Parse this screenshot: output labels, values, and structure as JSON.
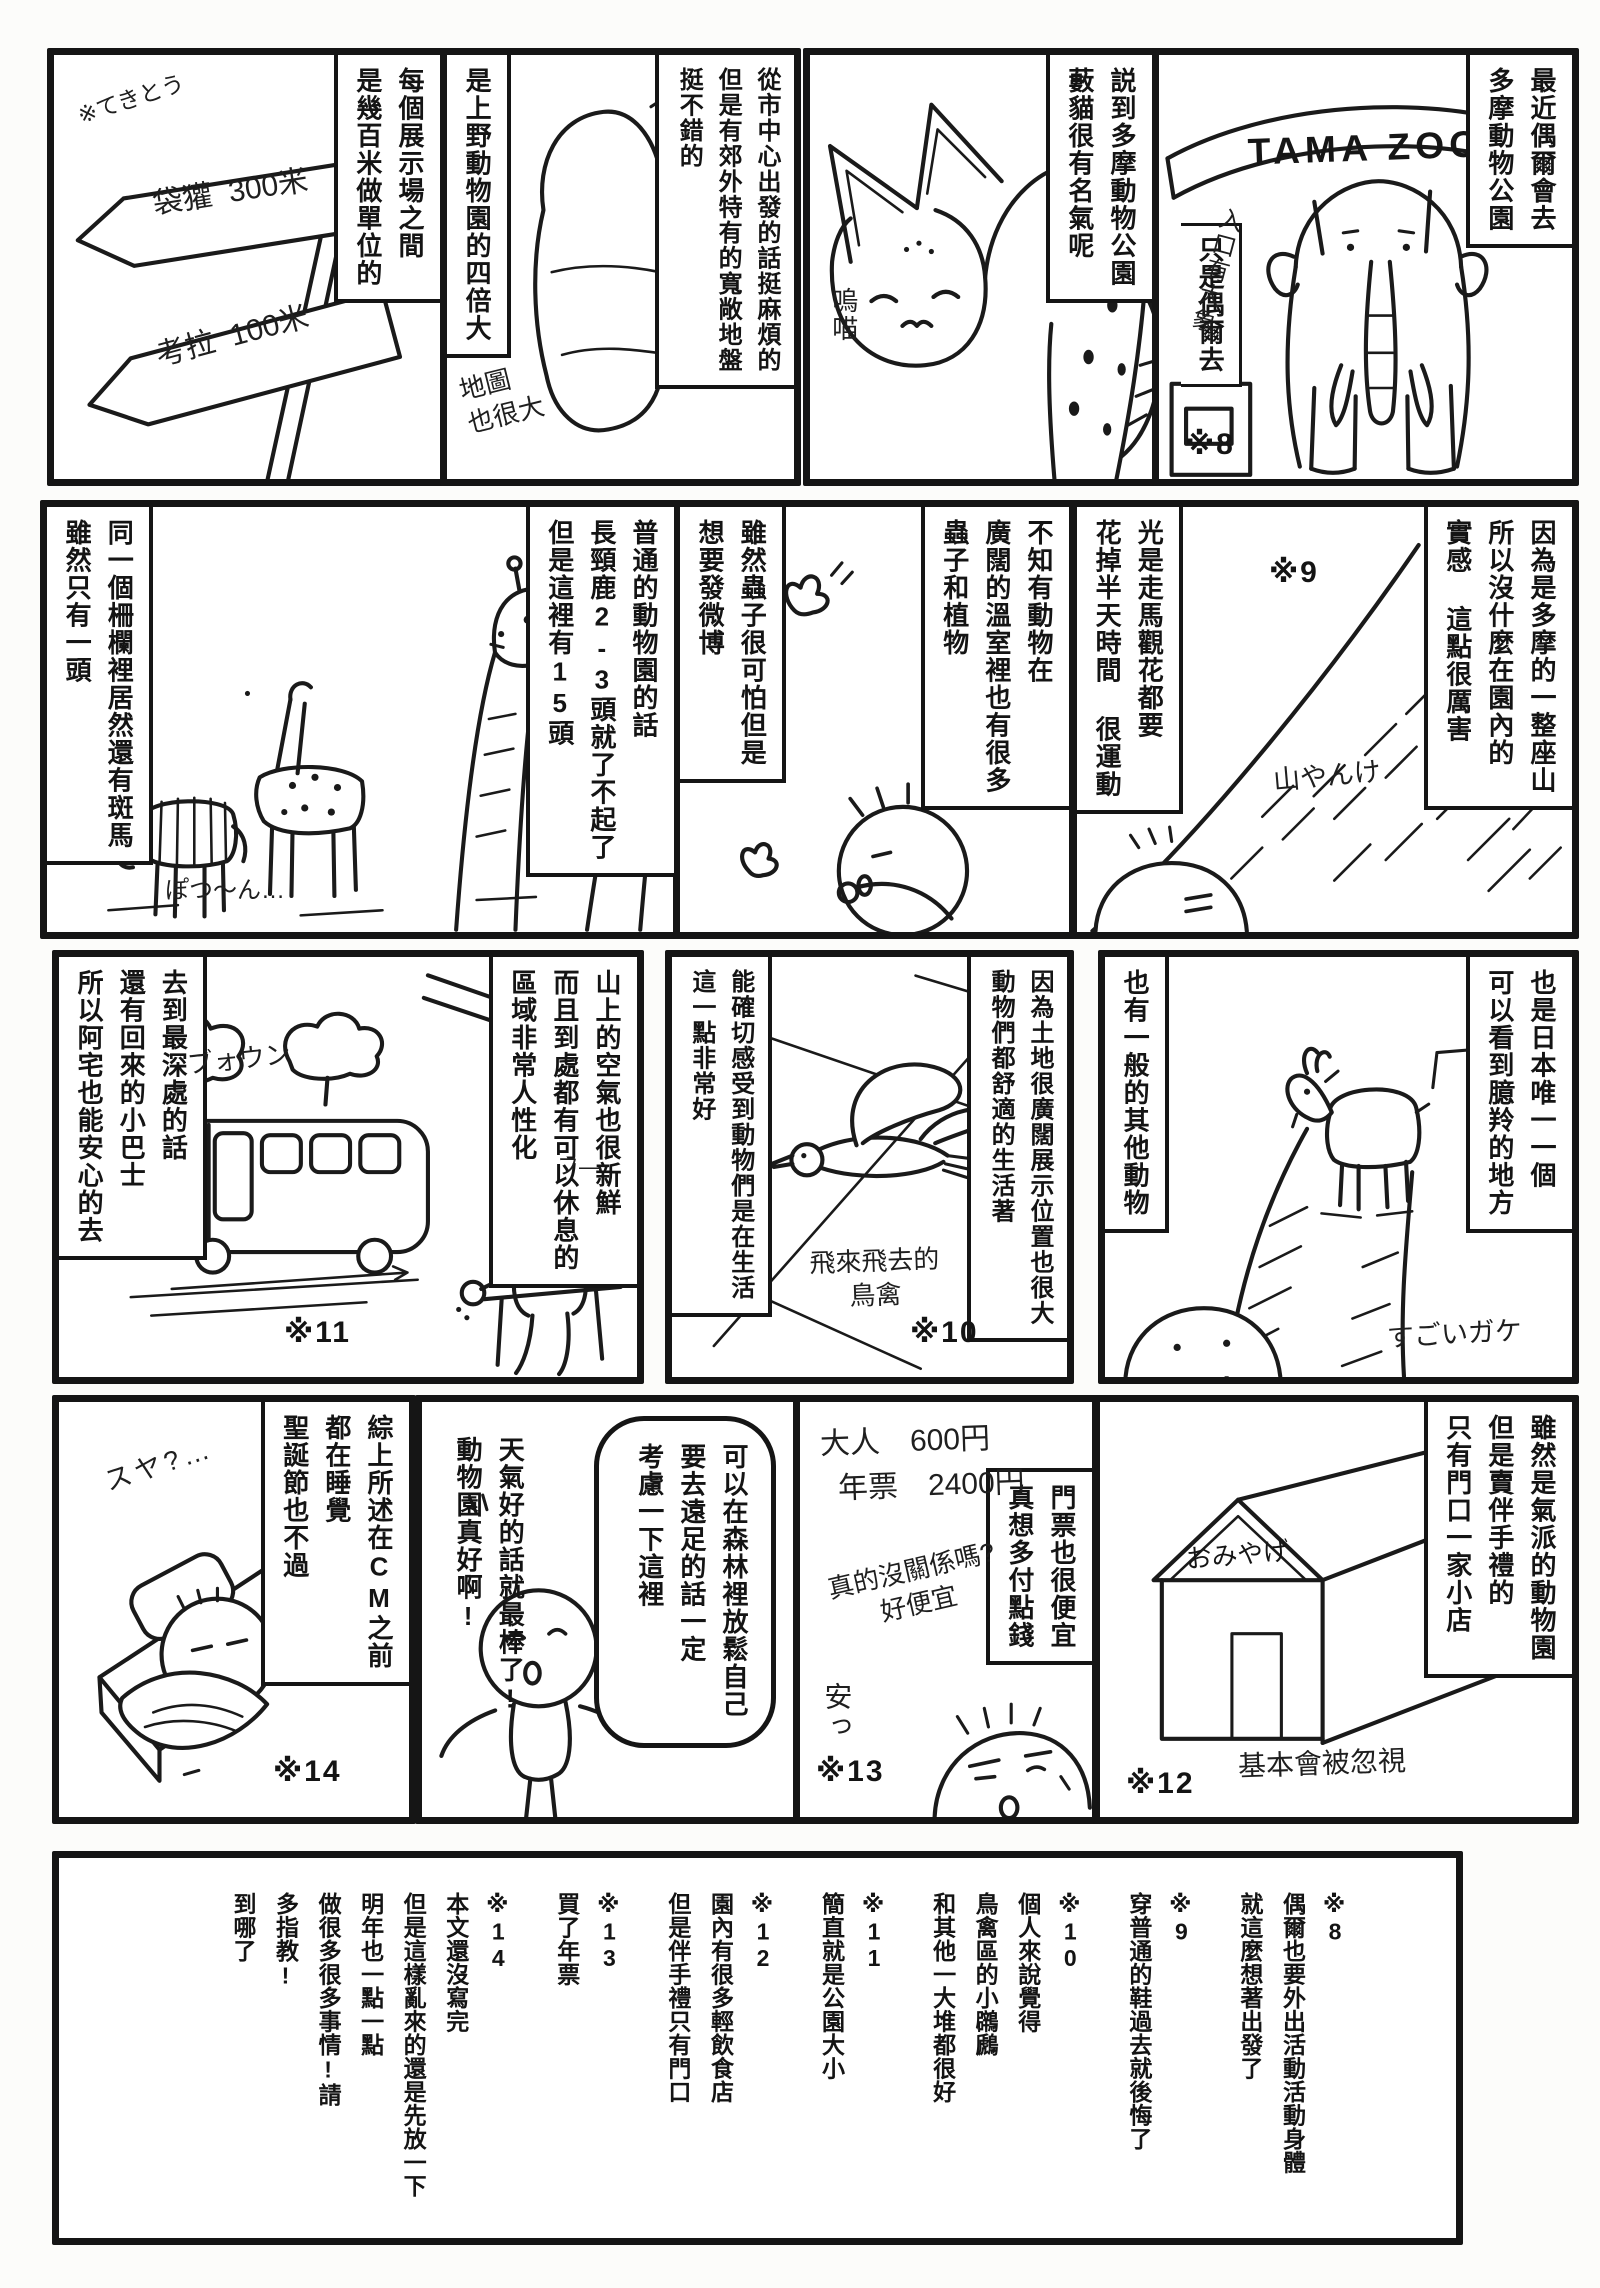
{
  "panels": {
    "signs": {
      "caption": "每個展示場之間\n是幾百米做單位的",
      "hand_note": "※てきとう",
      "sign_top": "袋獾  300米",
      "sign_bottom": "考拉  100米"
    },
    "map": {
      "caption_right": "從市中心出發的話挺麻煩的\n但是有郊外特有的寬敞地盤\n挺不錯的",
      "caption_left": "是上野動物園的四倍大",
      "map_label": "MAP",
      "hand_note": "地圖\n也很大"
    },
    "serval": {
      "caption": "説到多摩動物公園\n藪貓很有名氣呢",
      "hand_meow": "嗚喵"
    },
    "elephant": {
      "caption_right": "最近偶爾會去\n多摩動物公園",
      "caption_left": "只是偶爾去",
      "footnote_ref": "※8",
      "gate_sign": "TAMA ZOO",
      "hand_note": "入口有大象"
    },
    "giraffe": {
      "caption_right": "普通的動物園的話\n長頸鹿2-3頭就了不起了\n但是這裡有15頭",
      "caption_left": "同一個柵欄裡居然還有斑馬\n雖然只有一頭",
      "hand_note": "ぽつ〜ん…"
    },
    "greenhouse": {
      "caption_right": "不知有動物在\n廣闊的溫室裡也有很多\n蟲子和植物",
      "caption_left": "雖然蟲子很可怕但是\n想要發微博"
    },
    "mountain": {
      "caption_right": "因為是多摩的一整座山\n所以沒什麼在園內的\n實感 這點很厲害",
      "caption_left": "光是走馬觀花都要\n花掉半天時間 很運動",
      "footnote_ref": "※9",
      "hand_note": "山やんけ"
    },
    "bus": {
      "caption_right": "山上的空氣也很新鮮\n而且到處都有可以休息的\n區域非常人性化",
      "caption_left": "去到最深處的話\n還有回來的小巴士\n所以阿宅也能安心的去",
      "footnote_ref": "※11",
      "hand_sfx": "ブォウン",
      "hand_sigh": "フ—"
    },
    "bird": {
      "caption_right": "因為土地很廣闊展示位置也很大\n動物們都舒適的生活著",
      "caption_left": "能確切感受到動物們是在生活\n這一點非常好",
      "footnote_ref": "※10",
      "hand_note": "飛來飛去的\n鳥禽"
    },
    "goat": {
      "caption_right": "也是日本唯一一個\n可以看到臆羚的地方",
      "caption_left": "也有一般的其他動物",
      "hand_note": "すごいガケ"
    },
    "bed": {
      "caption": "綜上所述在CM之前\n都在睡覺\n聖誕節也不過",
      "footnote_ref": "※14",
      "hand_note": "スヤ?…"
    },
    "excited": {
      "caption": "天氣好的話就最棒了!\n動物園真好啊!",
      "bubble": "可以在森林裡放鬆自己\n要去遠足的話一定\n考慮一下這裡"
    },
    "ticket": {
      "price_line1": "大人　600円",
      "price_line2": "年票　2400円",
      "caption_right": "門票也很便宜\n真想多付點錢",
      "hand_note": "真的沒關係嗎?\n好便宜",
      "hand_cheap": "安っ",
      "footnote_ref": "※13"
    },
    "shop": {
      "caption": "雖然是氣派的動物園\n但是賣伴手禮的\n只有門口一家小店",
      "shop_sign": "おみやげ",
      "hand_note": "基本會被忽視",
      "footnote_ref": "※12"
    }
  },
  "footnotes": {
    "f8": "※8\n偶爾也要外出活動活動身體\n就這麼想著出發了",
    "f9": "※9\n穿普通的鞋過去就後悔了",
    "f10": "※10\n個人來說覺得\n鳥禽區的小鸊鷉\n和其他一大堆都很好",
    "f11": "※11\n簡直就是公園大小",
    "f12": "※12\n園內有很多輕飲食店\n但是伴手禮只有門口",
    "f13": "※13\n買了年票",
    "f14": "※14\n本文還沒寫完\n但是這樣亂來的還是先放一下\n明年也一點一點\n做很多很多事情!請\n多指教!\n到哪了"
  }
}
